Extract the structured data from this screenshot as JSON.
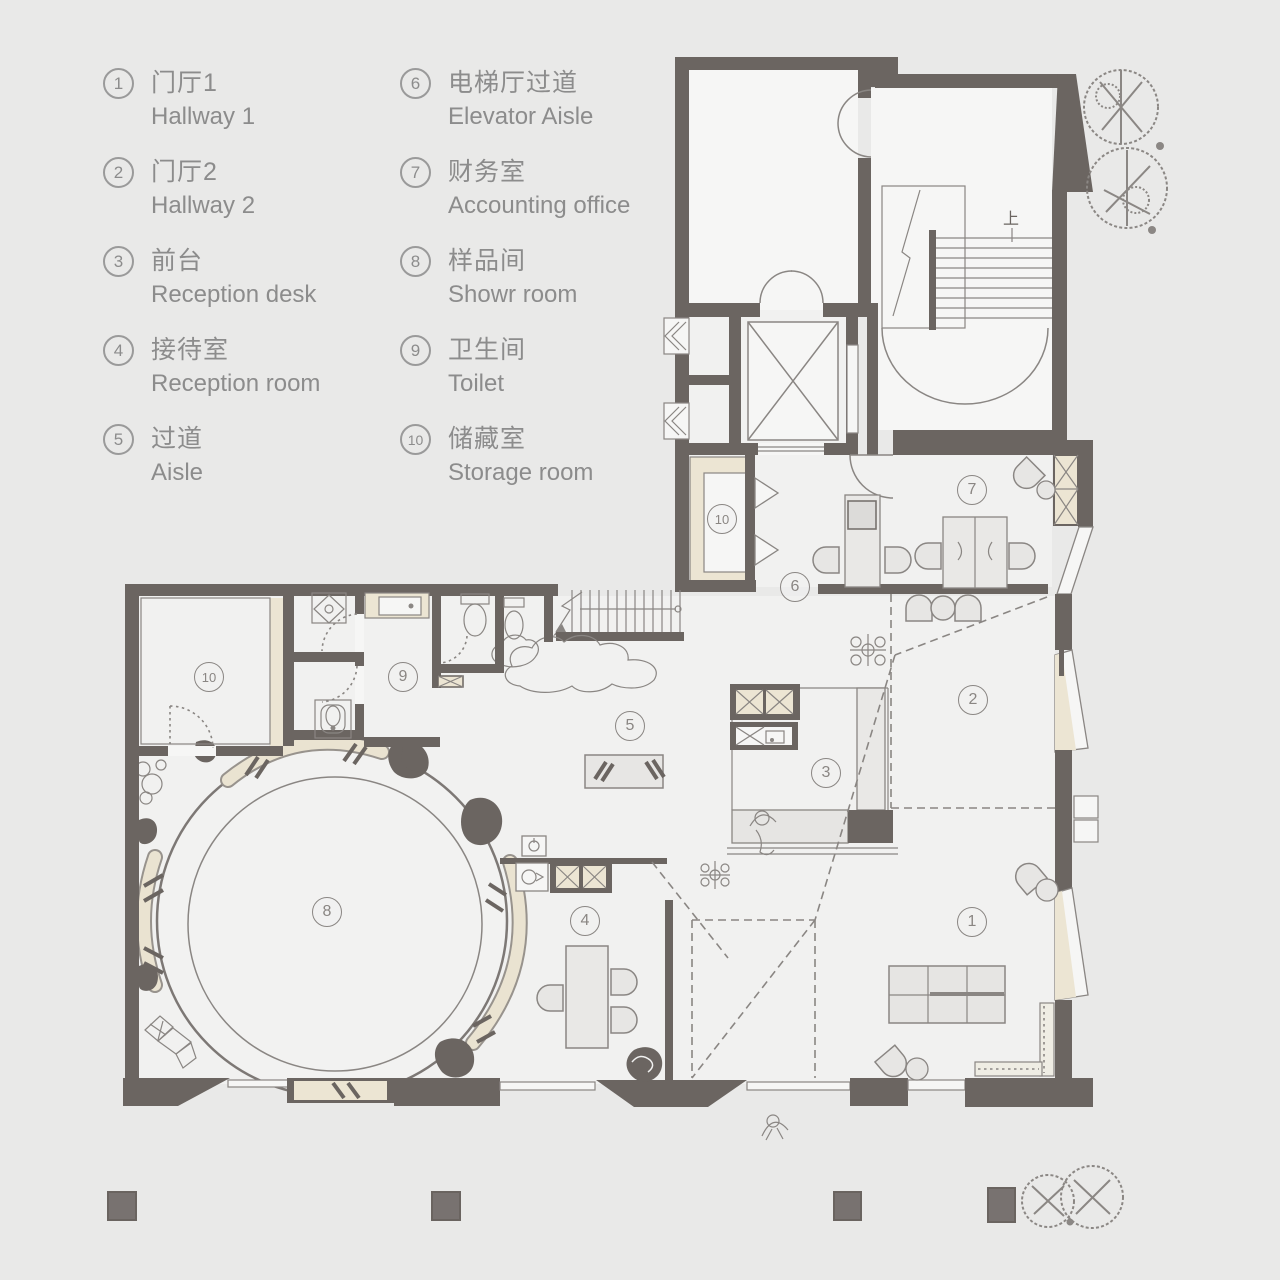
{
  "canvas": {
    "width": 1280,
    "height": 1280,
    "bg": "#e9e9e8"
  },
  "colors": {
    "wall": "#6b6561",
    "line": "#8a8683",
    "beige": "#ece5d3",
    "floor": "#f1f1f0",
    "furniture": "#e8e7e5",
    "legend_text": "#8c8c8c",
    "tree": "#8b8784",
    "column": "#787270"
  },
  "legend": {
    "items": [
      {
        "num": "1",
        "zh": "门厅1",
        "en": "Hallway 1"
      },
      {
        "num": "2",
        "zh": "门厅2",
        "en": "Hallway 2"
      },
      {
        "num": "3",
        "zh": "前台",
        "en": "Reception desk"
      },
      {
        "num": "4",
        "zh": "接待室",
        "en": "Reception room"
      },
      {
        "num": "5",
        "zh": "过道",
        "en": "Aisle"
      },
      {
        "num": "6",
        "zh": "电梯厅过道",
        "en": "Elevator Aisle"
      },
      {
        "num": "7",
        "zh": "财务室",
        "en": "Accounting office"
      },
      {
        "num": "8",
        "zh": "样品间",
        "en": "Showr room"
      },
      {
        "num": "9",
        "zh": "卫生间",
        "en": "Toilet"
      },
      {
        "num": "10",
        "zh": "储藏室",
        "en": "Storage room"
      }
    ]
  },
  "plan": {
    "stair_up_label": "上",
    "labels": [
      {
        "num": "1",
        "x": 972,
        "y": 922
      },
      {
        "num": "2",
        "x": 973,
        "y": 700
      },
      {
        "num": "3",
        "x": 826,
        "y": 773
      },
      {
        "num": "4",
        "x": 585,
        "y": 921
      },
      {
        "num": "5",
        "x": 630,
        "y": 726
      },
      {
        "num": "6",
        "x": 795,
        "y": 587
      },
      {
        "num": "7",
        "x": 972,
        "y": 490
      },
      {
        "num": "8",
        "x": 327,
        "y": 912
      },
      {
        "num": "9",
        "x": 403,
        "y": 677
      },
      {
        "num": "10",
        "x": 209,
        "y": 677
      },
      {
        "num": "10",
        "x": 722,
        "y": 519
      }
    ]
  }
}
